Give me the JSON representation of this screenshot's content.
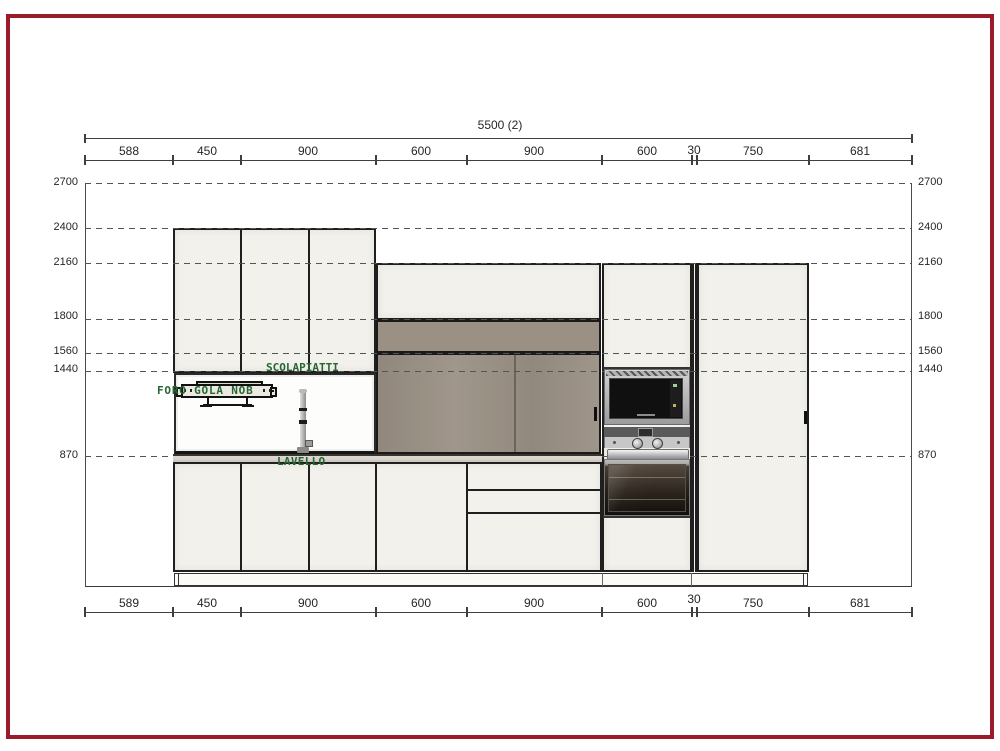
{
  "drawing": {
    "type": "kitchen elevation CAD drawing",
    "frame_color": "#9b1b2d"
  },
  "dimensions": {
    "total_top": "5500 (2)",
    "top": [
      "588",
      "450",
      "900",
      "600",
      "900",
      "600",
      "30",
      "750",
      "681"
    ],
    "bottom": [
      "589",
      "450",
      "900",
      "600",
      "900",
      "600",
      "30",
      "750",
      "681"
    ],
    "heights": [
      "2700",
      "2400",
      "2160",
      "1800",
      "1560",
      "1440",
      "870"
    ]
  },
  "annotations": {
    "dish_rack": "SCOLAPIATTI",
    "tap_hole": "FORO GOLA NOB",
    "sink": "LAVELLO"
  },
  "colors": {
    "frame": "#9b1b2d",
    "cabinet_fill": "#f2f1eb",
    "wood_panel": "#9a9084",
    "annotation_green": "#266632",
    "line": "#3a3a3a"
  }
}
